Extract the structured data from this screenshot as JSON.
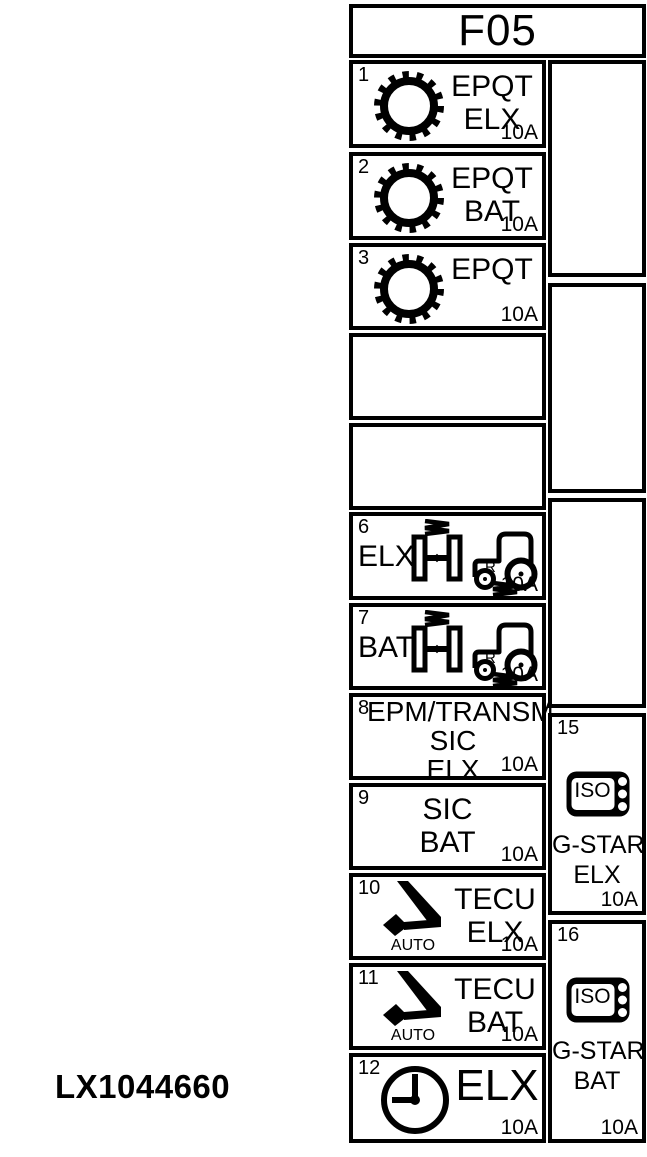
{
  "caption": "LX1044660",
  "panel": {
    "title": "F05",
    "cells": {
      "c1": {
        "number": "1",
        "icon": "gear-icon",
        "line1": "EPQT",
        "line2": "ELX",
        "rating": "10A"
      },
      "c2": {
        "number": "2",
        "icon": "gear-icon",
        "line1": "EPQT",
        "line2": "BAT",
        "rating": "10A"
      },
      "c3": {
        "number": "3",
        "icon": "gear-icon",
        "line1": "EPQT",
        "rating": "10A"
      },
      "c6": {
        "number": "6",
        "icon": "axle-tractor-icon",
        "prefix": "ELX",
        "axle_letter": "R",
        "rating": "10A"
      },
      "c7": {
        "number": "7",
        "icon": "axle-tractor-icon",
        "prefix": "BAT",
        "axle_letter": "R",
        "rating": "10A"
      },
      "c8": {
        "number": "8",
        "line1": "EPM/TRANSM",
        "line2": "SIC",
        "line3": "ELX",
        "rating": "10A"
      },
      "c9": {
        "number": "9",
        "line1": "SIC",
        "line2": "BAT",
        "rating": "10A"
      },
      "c10": {
        "number": "10",
        "icon": "shift-lever-icon",
        "icon_label": "AUTO",
        "line1": "TECU",
        "line2": "ELX",
        "rating": "10A"
      },
      "c11": {
        "number": "11",
        "icon": "shift-lever-icon",
        "icon_label": "AUTO",
        "line1": "TECU",
        "line2": "BAT",
        "rating": "10A"
      },
      "c12": {
        "number": "12",
        "icon": "clock-icon",
        "line1": "ELX",
        "rating": "10A"
      },
      "c15": {
        "number": "15",
        "icon": "iso-connector-icon",
        "icon_text": "ISO",
        "line1": "G-STAR",
        "line2": "ELX",
        "rating": "10A"
      },
      "c16": {
        "number": "16",
        "icon": "iso-connector-icon",
        "icon_text": "ISO",
        "line1": "G-STAR",
        "line2": "BAT",
        "rating": "10A"
      }
    }
  }
}
